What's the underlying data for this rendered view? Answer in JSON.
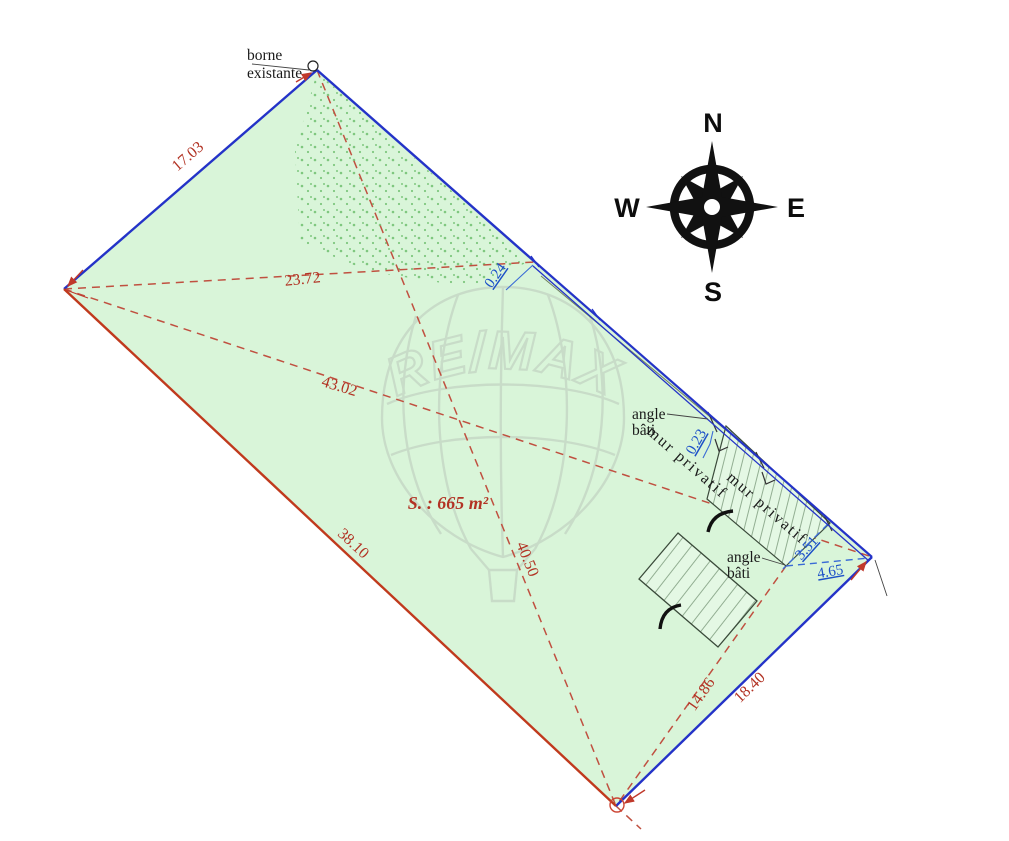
{
  "plan": {
    "area": "S. : 665 m²",
    "dimensions_red": {
      "edge_top_left": "17.03",
      "diagonal_upper": "23.72",
      "diagonal_long": "43.02",
      "edge_left": "38.10",
      "diagonal_vertical": "40.50",
      "diagonal_lower": "14.86",
      "edge_bottom_right": "18.40"
    },
    "dimensions_blue": {
      "offset_top": "0.24",
      "offset_middle": "0.23",
      "wall_end": "3.51",
      "corner_gap": "4.65"
    },
    "labels": {
      "borne_line1": "borne",
      "borne_line2": "existante",
      "angle1_line1": "angle",
      "angle1_line2": "bâti",
      "angle2_line1": "angle",
      "angle2_line2": "bâti",
      "mur_privatif_1": "mur privatif",
      "mur_privatif_2": "mur privatif"
    }
  },
  "compass": {
    "north": "N",
    "east": "E",
    "south": "S",
    "west": "W"
  },
  "watermark": {
    "brand": "RE/MAX"
  },
  "colors": {
    "parcel_fill": "#d9f5d9",
    "boundary_blue": "#2433c8",
    "boundary_red": "#c03a1d",
    "dashed_red": "#c05040",
    "dim_red_text": "#b23324",
    "dim_blue_text": "#1c50c8",
    "compass_black": "#111111",
    "watermark_gray": "#b3bcb3"
  }
}
